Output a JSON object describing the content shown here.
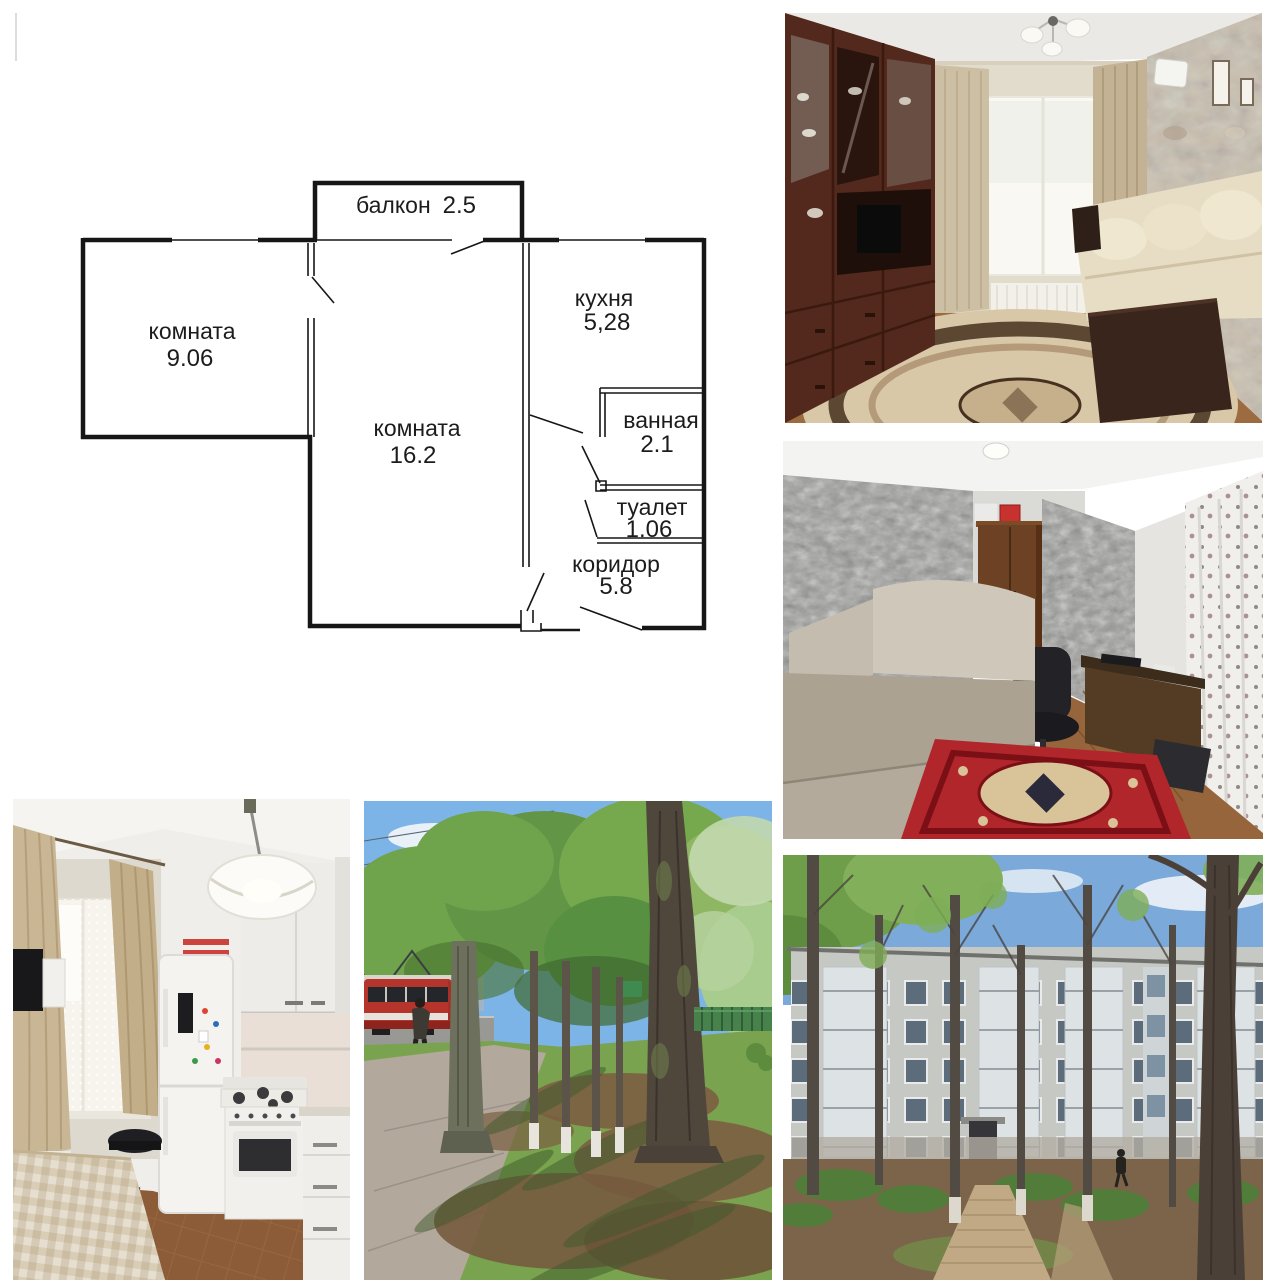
{
  "collage": {
    "background": "#ffffff"
  },
  "floorplan": {
    "balcony_label": "балкон",
    "balcony_area": "2.5",
    "rooms": [
      {
        "id": "room-9",
        "name": "комната",
        "area": "9.06"
      },
      {
        "id": "room-16",
        "name": "комната",
        "area": "16.2"
      },
      {
        "id": "kitchen",
        "name": "кухня",
        "area": "5,28"
      },
      {
        "id": "bathroom",
        "name": "ванная",
        "area": "2.1"
      },
      {
        "id": "toilet",
        "name": "туалет",
        "area": "1.06"
      },
      {
        "id": "corridor",
        "name": "коридор",
        "area": "5.8"
      }
    ],
    "line_color": "#161616"
  },
  "photos": [
    {
      "id": "living-room",
      "palette": {
        "cabinet_wood": "#54291d",
        "sofa": "#e7ddc4",
        "rug": "#d8c8a8",
        "rug_border": "#46301f",
        "stone_wall": "#c9bfae",
        "curtain": "#cdbfa3",
        "floor": "#9c6b40"
      }
    },
    {
      "id": "small-room",
      "palette": {
        "wallpaper": "#9a9a98",
        "back_wall": "#dadad6",
        "wardrobe": "#6d4124",
        "sofa": "#aba291",
        "rug": "#b0262b",
        "floor": "#96653c"
      }
    },
    {
      "id": "kitchen",
      "palette": {
        "fridge": "#f4f3f0",
        "cabinets": "#edece8",
        "drape": "#c9b694",
        "stove": "#f1f0ec",
        "tablecloth": "#d9cdb6",
        "floor_tile": "#8c5c38"
      }
    },
    {
      "id": "street",
      "palette": {
        "sky": "#7db4e8",
        "foliage": "#6fa34c",
        "tram": "#b5342c",
        "grass": "#7aa34f",
        "dirt": "#7b5e41",
        "sidewalk": "#b3a89c",
        "trunk": "#4f463c"
      }
    },
    {
      "id": "courtyard",
      "palette": {
        "sky": "#7aa9da",
        "facade": "#c6c8c4",
        "ground": "#7b6449",
        "path": "#c2a985",
        "shrub": "#527c3a",
        "trunk": "#4b4038"
      }
    }
  ]
}
